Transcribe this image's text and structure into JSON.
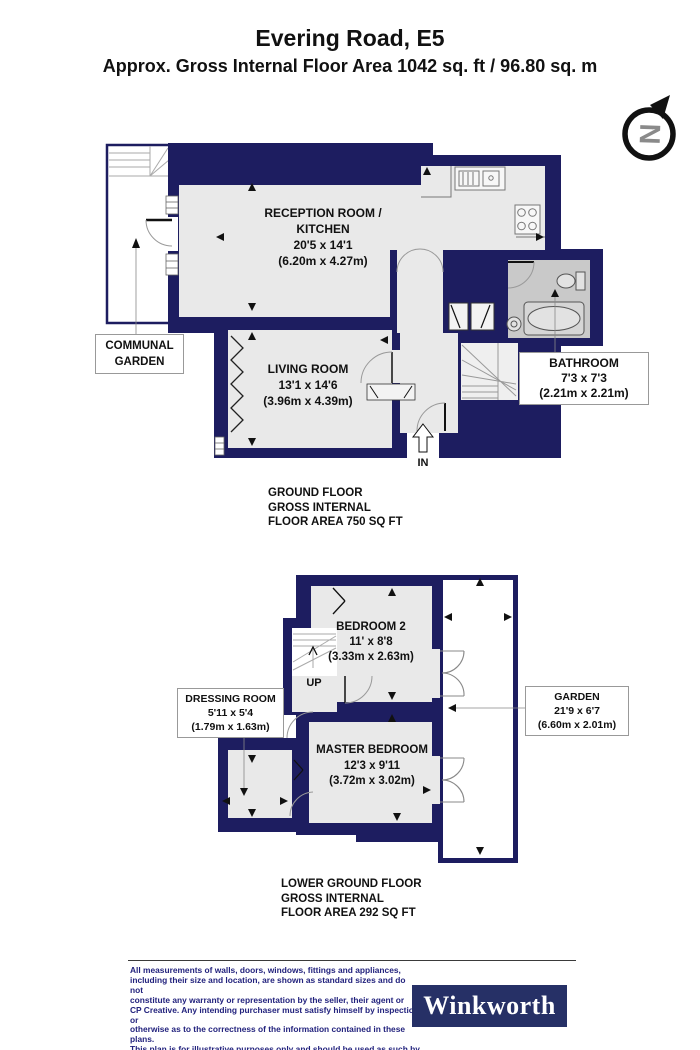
{
  "header": {
    "title": "Evering Road, E5",
    "subtitle": "Approx. Gross Internal Floor Area 1042 sq. ft / 96.80 sq. m"
  },
  "compass": {
    "letter": "N"
  },
  "ground_floor": {
    "caption": "GROUND FLOOR\nGROSS INTERNAL\nFLOOR AREA 750 SQ FT",
    "rooms": {
      "reception": {
        "label": "RECEPTION ROOM /\nKITCHEN\n20'5 x 14'1\n(6.20m x 4.27m)"
      },
      "living": {
        "label": "LIVING ROOM\n13'1 x 14'6\n(3.96m x 4.39m)"
      },
      "bathroom": {
        "label": "BATHROOM\n7'3 x 7'3\n(2.21m x 2.21m)"
      },
      "communal_garden": {
        "label": "COMMUNAL\nGARDEN"
      },
      "entrance": {
        "label": "IN"
      }
    }
  },
  "lower_floor": {
    "caption": "LOWER GROUND FLOOR\nGROSS INTERNAL\nFLOOR AREA 292 SQ FT",
    "rooms": {
      "bedroom2": {
        "label": "BEDROOM 2\n11' x 8'8\n(3.33m x 2.63m)"
      },
      "master": {
        "label": "MASTER BEDROOM\n12'3 x 9'11\n(3.72m x 3.02m)"
      },
      "dressing": {
        "label": "DRESSING ROOM\n5'11 x 5'4\n(1.79m x 1.63m)"
      },
      "garden": {
        "label": "GARDEN\n21'9 x 6'7\n(6.60m x 2.01m)"
      },
      "stairs": {
        "label": "UP"
      }
    }
  },
  "footer": {
    "disclaimer": "All measurements of walls, doors, windows, fittings and appliances,\nincluding their size and location, are shown as standard sizes and do not\nconstitute any warranty or representation by the seller, their agent or\nCP Creative. Any intending purchaser must satisfy himself by inspection or\notherwise as to the correctness of the information contained in these plans.\nThis plan is for illustrative purposes only and should be used as such by\nany prospective purchasers.",
    "brand": "Winkworth"
  },
  "colors": {
    "wall": "#1d1d60",
    "floor": "#e9e9e9",
    "bathroom_floor": "#c9c9c9",
    "brand_bg": "#263066",
    "disclaimer_text": "#22227d"
  }
}
